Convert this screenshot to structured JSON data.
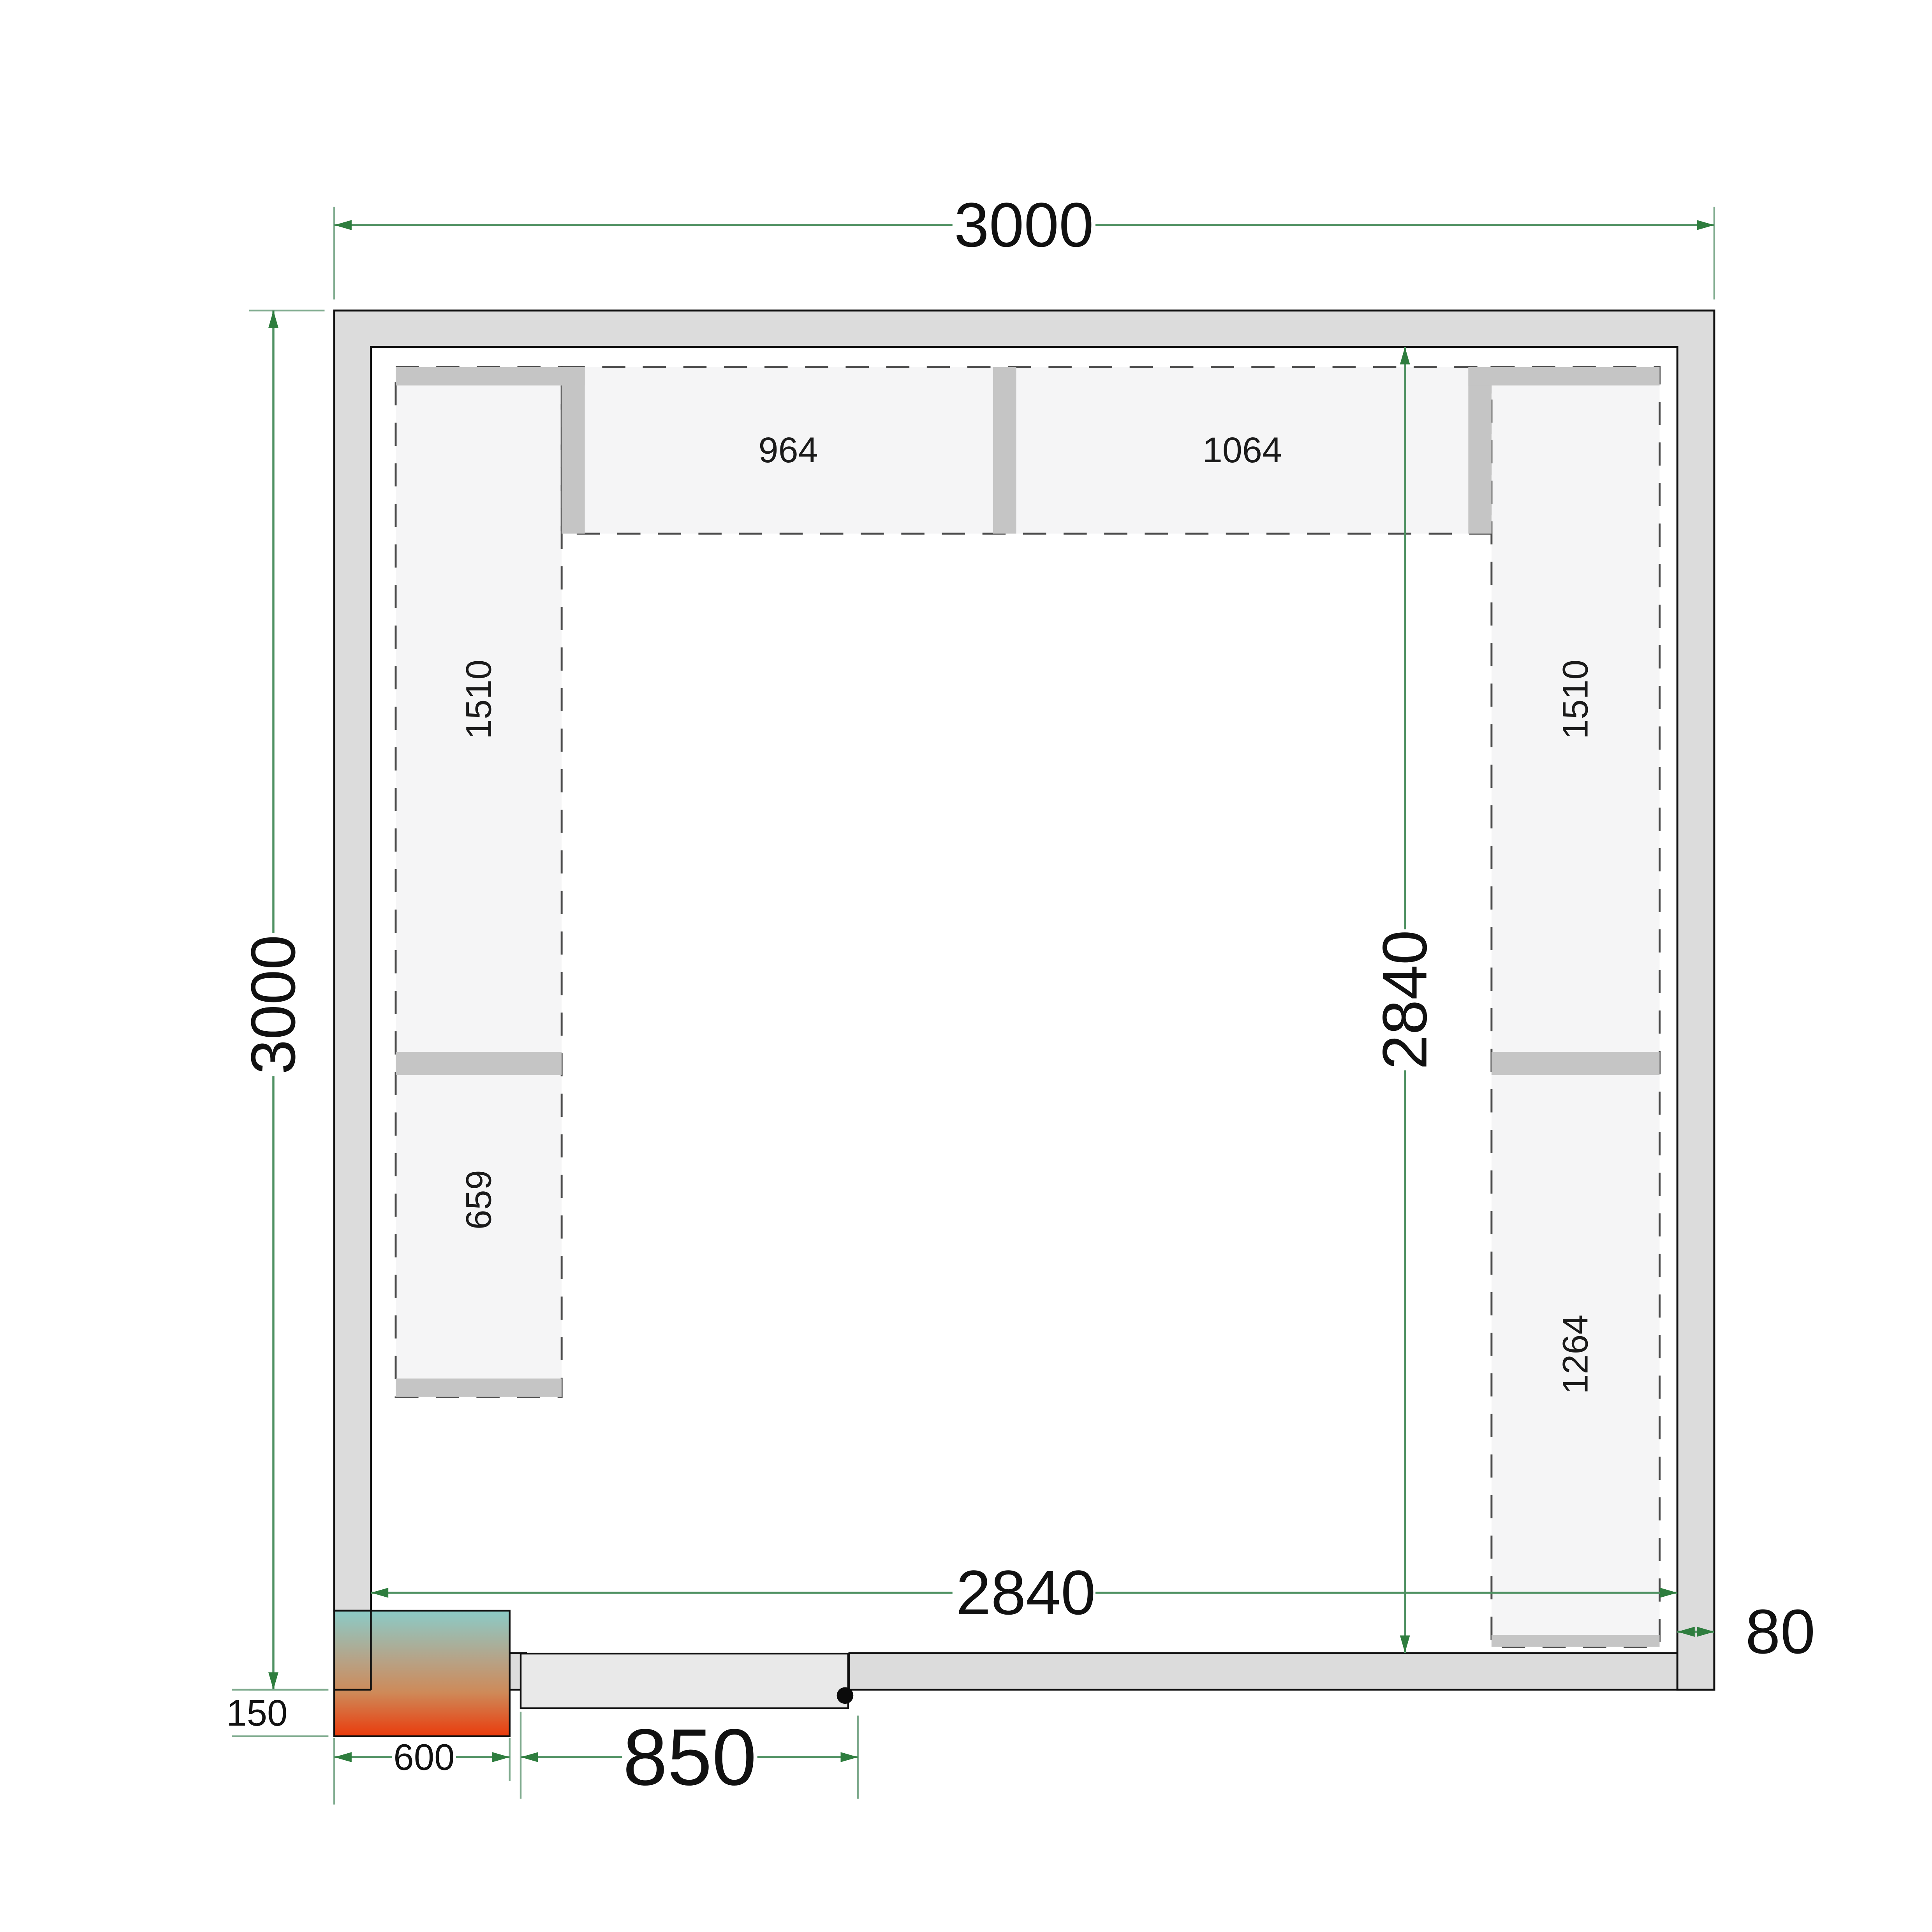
{
  "title": "Cold room floor plan with shelving",
  "labels": {
    "outer_width": "3000",
    "outer_height": "3000",
    "inner_width": "2840",
    "inner_height": "2840",
    "wall_thickness": "80",
    "unit_width": "600",
    "unit_offset": "150",
    "door_width": "850"
  },
  "shelves": {
    "left_upper": "1510",
    "left_lower": "659",
    "top_left": "964",
    "top_right": "1064",
    "right_upper": "1510",
    "right_lower": "1264"
  },
  "colors": {
    "green-dark": "#2e7d3e",
    "green-line": "#4f9162",
    "green-ext": "#7fab8e",
    "wall": "#dcdcdc",
    "shelf": "#f5f5f6",
    "bar": "#c5c5c5",
    "door": "#e9e9e9",
    "unit-top": "#8bcbc7",
    "unit-mid1": "#b5a489",
    "unit-mid2": "#ce8a59",
    "unit-bottom": "#ea3b0c"
  }
}
